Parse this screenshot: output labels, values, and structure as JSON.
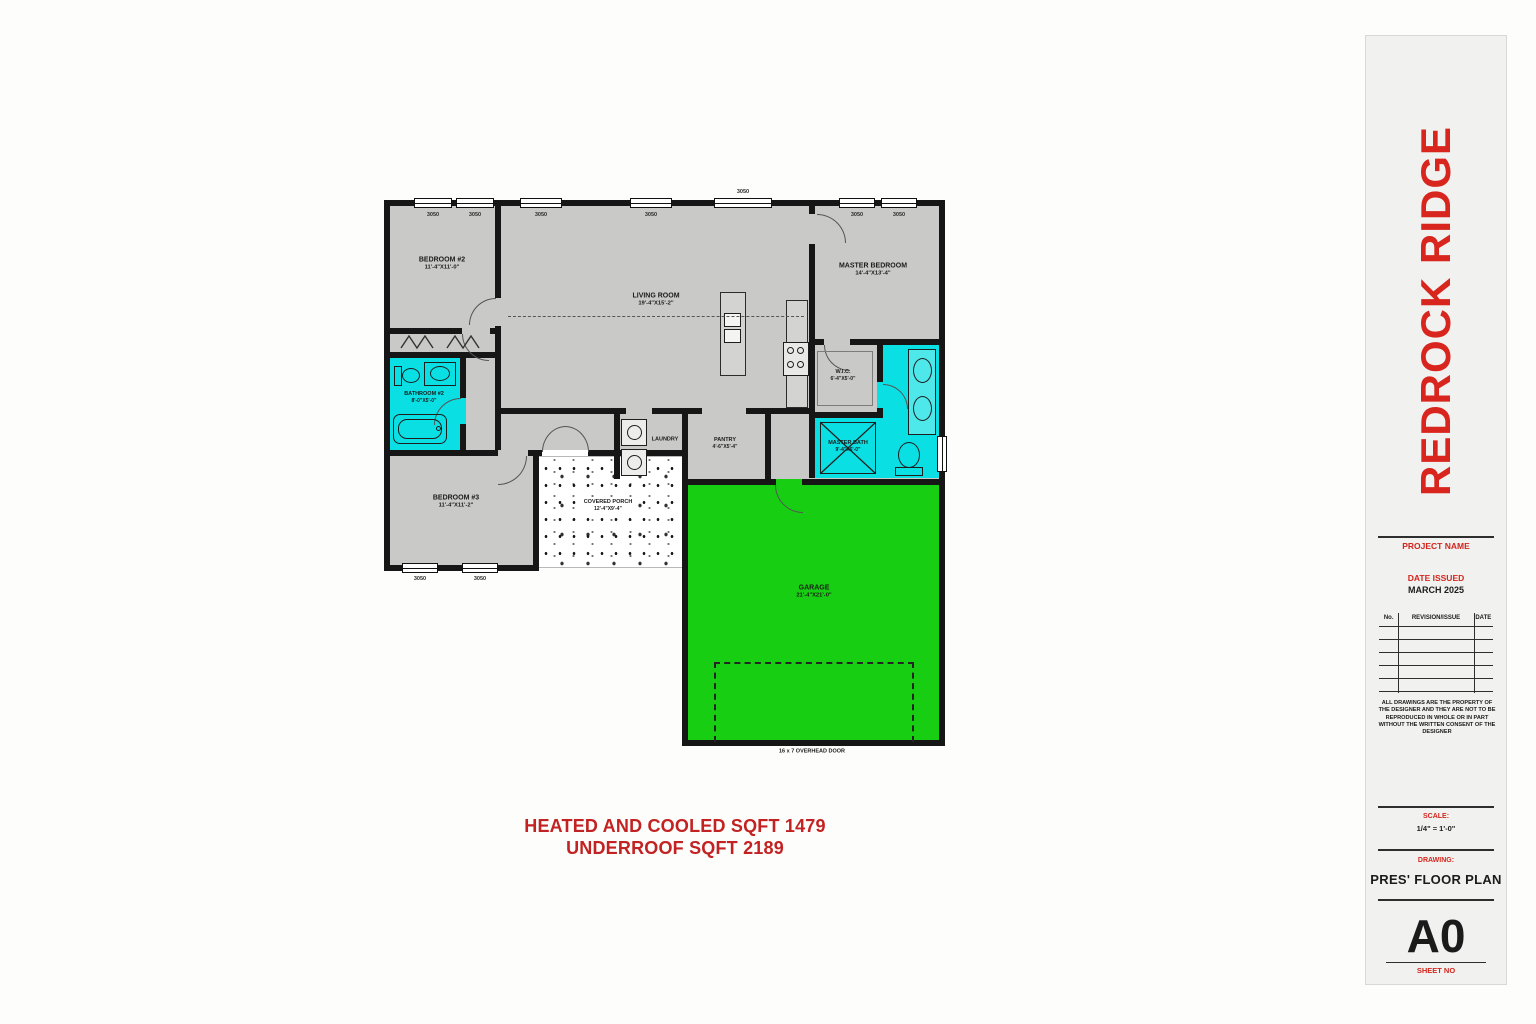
{
  "summary": {
    "line1": "HEATED AND COOLED SQFT 1479",
    "line2": "UNDERROOF SQFT 2189"
  },
  "title_block": {
    "project_title": "REDROCK RIDGE",
    "project_name_label": "PROJECT NAME",
    "date_issued_label": "DATE ISSUED",
    "date_issued": "MARCH 2025",
    "rev_col_no": "No.",
    "rev_col_revision": "REVISION/ISSUE",
    "rev_col_date": "DATE",
    "disclaimer": "ALL DRAWINGS ARE THE PROPERTY OF THE DESIGNER AND THEY ARE NOT TO BE REPRODUCED IN WHOLE OR IN PART WITHOUT THE WRITTEN CONSENT OF THE DESIGNER",
    "scale_label": "SCALE:",
    "scale_value": "1/4\" = 1'-0\"",
    "drawing_label": "DRAWING:",
    "drawing_name": "PRES' FLOOR PLAN",
    "sheet_number": "A0",
    "sheet_no_label": "SHEET NO"
  },
  "plan": {
    "rooms": {
      "bedroom2": {
        "name": "BEDROOM #2",
        "dims": "11'-4\"X11'-0\""
      },
      "living": {
        "name": "LIVING ROOM",
        "dims": "19'-4\"X15'-2\""
      },
      "master_bedroom": {
        "name": "MASTER BEDROOM",
        "dims": "14'-4\"X13'-4\""
      },
      "bathroom2": {
        "name": "BATHROOM #2",
        "dims": "8'-0\"X5'-0\""
      },
      "bedroom3": {
        "name": "BEDROOM #3",
        "dims": "11'-4\"X11'-2\""
      },
      "wic": {
        "name": "W.I.C.",
        "dims": "6'-4\"X5'-0\""
      },
      "master_bath": {
        "name": "MASTER BATH",
        "dims": "9'-4\"X6'-0\""
      },
      "laundry": {
        "name": "LAUNDRY"
      },
      "pantry": {
        "name": "PANTRY",
        "dims": "4'-6\"X5'-4\""
      },
      "porch": {
        "name": "COVERED PORCH",
        "dims": "12'-4\"X9'-4\""
      },
      "garage": {
        "name": "GARAGE",
        "dims": "21'-4\"X21'-0\""
      }
    },
    "annotations": {
      "overhead_door": "16 x 7 OVERHEAD DOOR"
    },
    "window_labels": {
      "top": [
        "3050",
        "3050",
        "3050",
        "3050",
        "3050",
        "3050",
        "3050"
      ],
      "bottom": [
        "3050",
        "3050"
      ]
    },
    "colors": {
      "wet_area": "#0ADFE4",
      "garage_green": "#17CE12",
      "room_gray": "#C9C9C7",
      "wall": "#161616",
      "accent_red": "#D3251D"
    }
  }
}
